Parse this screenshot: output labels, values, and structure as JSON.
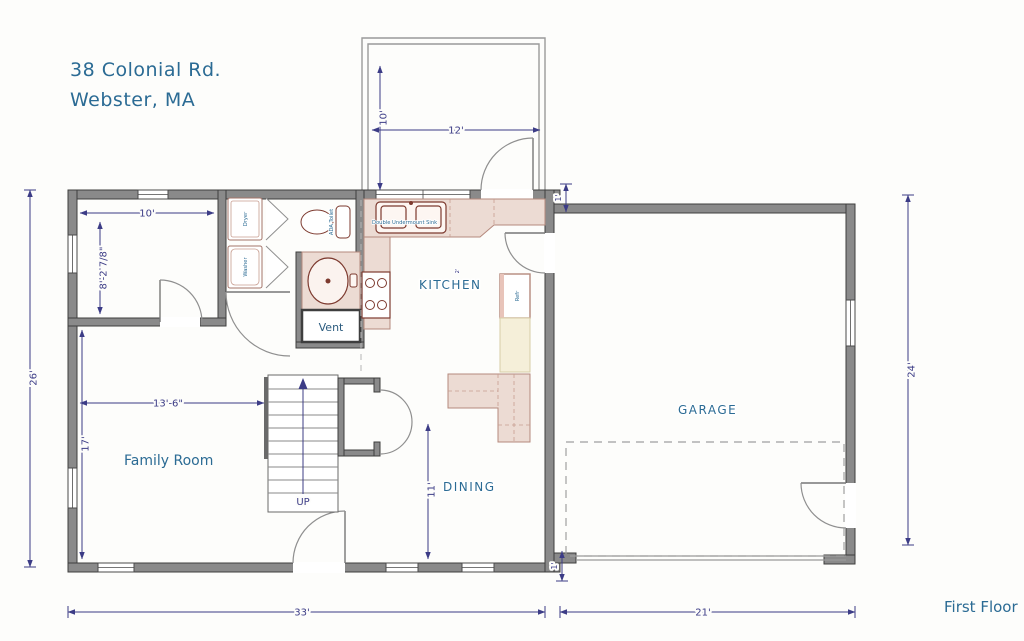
{
  "title": {
    "line1": "38 Colonial Rd.",
    "line2": "Webster, MA"
  },
  "footer": {
    "first_floor": "First Floor"
  },
  "rooms": {
    "family_room": "Family Room",
    "kitchen": "KITCHEN",
    "dining": "DINING",
    "garage": "GARAGE",
    "up": "UP",
    "vent": "Vent"
  },
  "fixtures": {
    "dryer": "Dryer",
    "washer": "Washer",
    "ada_toilet": "ADA Toilet",
    "sink": "Double Undermount Sink",
    "refrigerator": "Refr"
  },
  "dimensions": {
    "deck_depth": "10'",
    "deck_width": "12'",
    "office_width": "10'",
    "office_depth": "8'-2 7/8\"",
    "left_height": "26'",
    "family_width": "13'-6\"",
    "family_height": "17'",
    "dining_height": "11'",
    "house_width": "33'",
    "garage_width": "21'",
    "garage_height": "24'",
    "jog_top": "1'",
    "jog_bottom": "1'",
    "counter": "2'"
  },
  "colors": {
    "label_blue": "#2b6b94",
    "dimension_navy": "#3c3c86",
    "wall_gray": "#8a8a8a",
    "counter_pink": "#ecdbd3",
    "fixture_red": "#7d3a2f"
  }
}
